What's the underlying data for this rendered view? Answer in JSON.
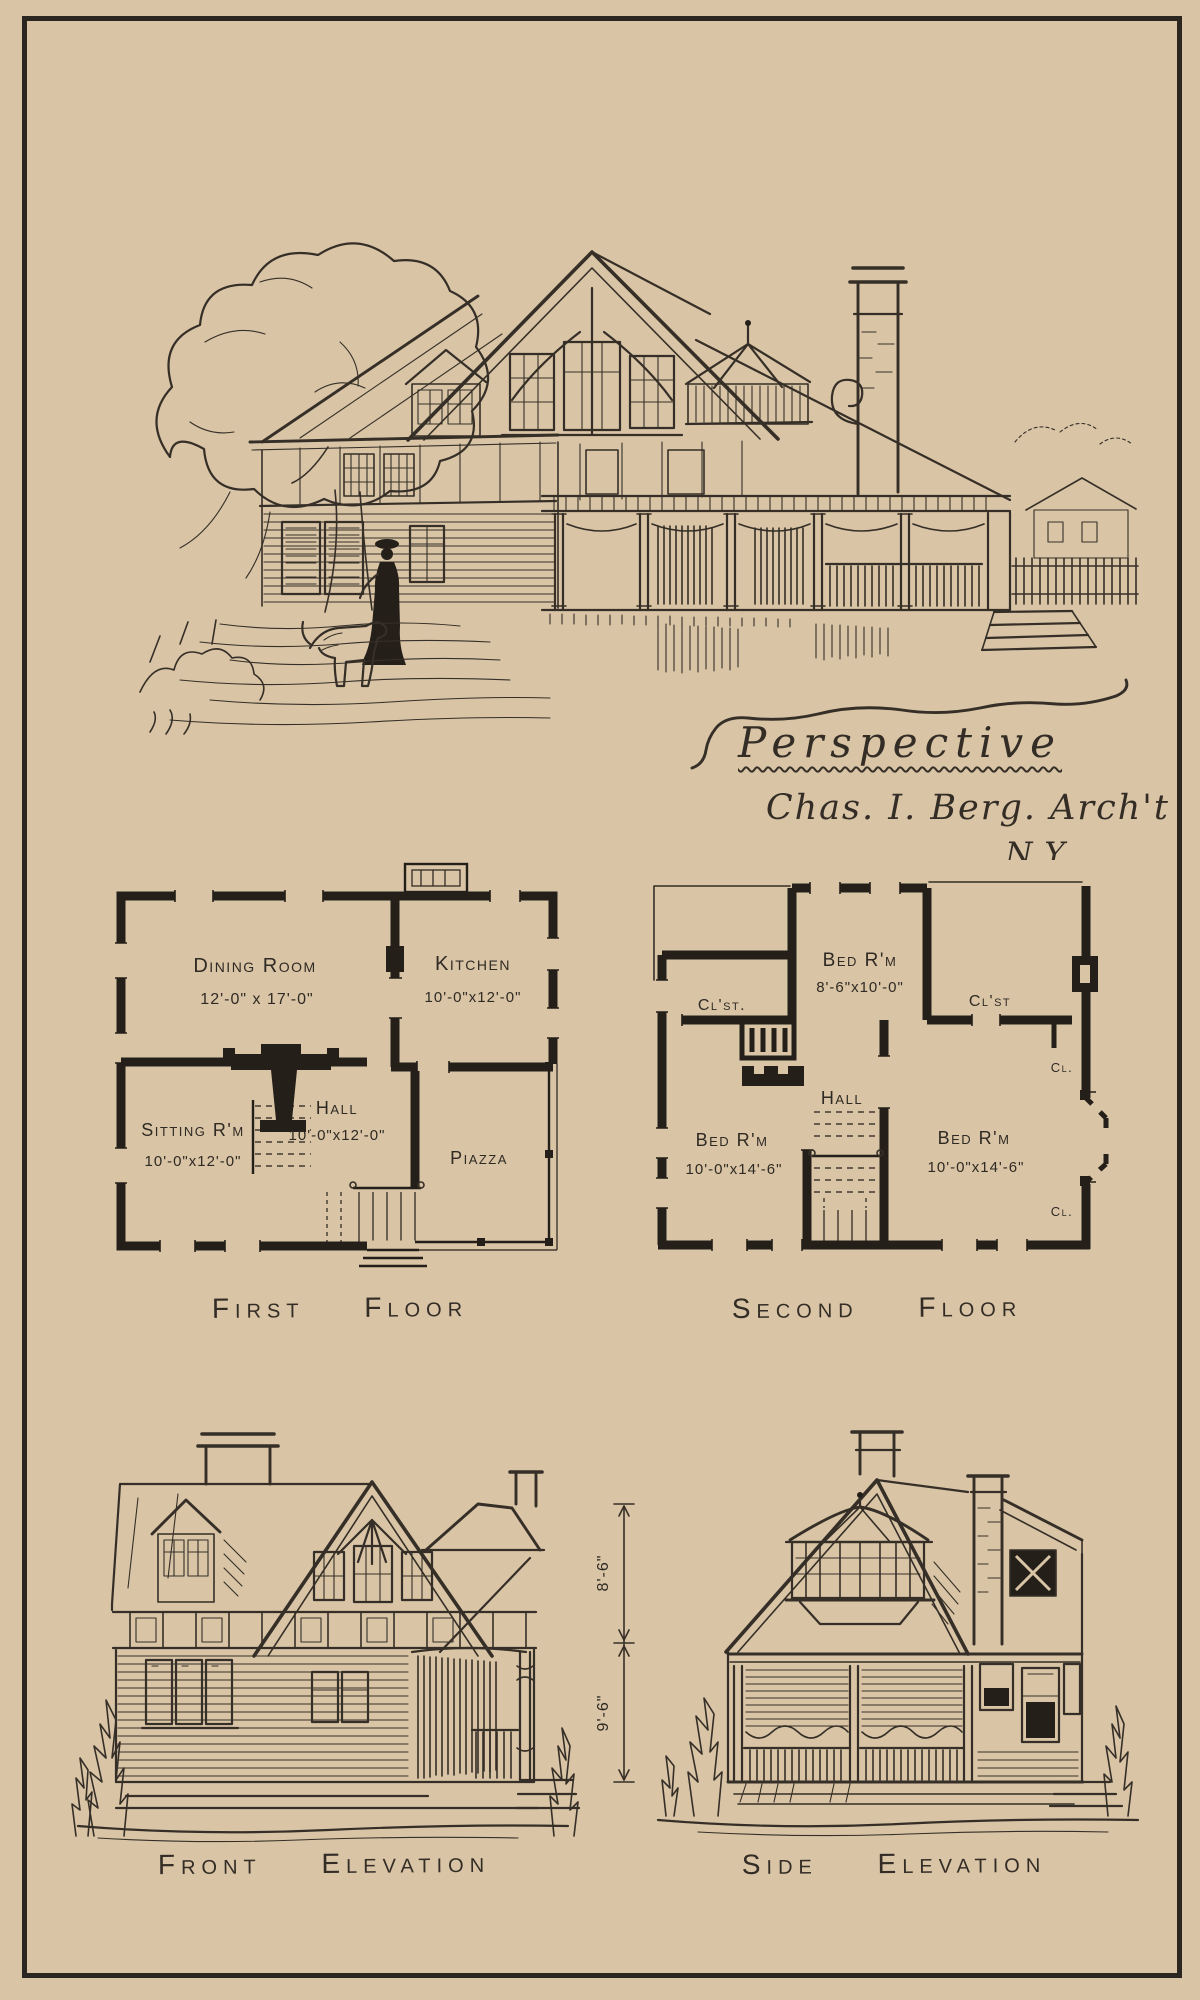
{
  "plate": {
    "perspective_label": "Perspective",
    "architect": "Chas. I. Berg. Arch't",
    "city": "N.Y."
  },
  "first_floor": {
    "caption": "First Floor",
    "dining": {
      "name": "Dining Room",
      "dims": "12'-0\" x 17'-0\""
    },
    "kitchen": {
      "name": "Kitchen",
      "dims": "10'-0\"x12'-0\""
    },
    "sitting": {
      "name": "Sitting R'm",
      "dims": "10'-0\"x12'-0\""
    },
    "hall": {
      "name": "Hall",
      "dims": "10'-0\"x12'-0\""
    },
    "piazza": {
      "name": "Piazza"
    }
  },
  "second_floor": {
    "caption": "Second Floor",
    "bed_top": {
      "name": "Bed R'm",
      "dims": "8'-6\"x10'-0\""
    },
    "closet_left": {
      "name": "Cl'st."
    },
    "closet_right": {
      "name": "Cl'st"
    },
    "closet_upper_right": {
      "name": "Cl."
    },
    "hall": {
      "name": "Hall"
    },
    "bed_left": {
      "name": "Bed R'm",
      "dims": "10'-0\"x14'-6\""
    },
    "bed_right": {
      "name": "Bed R'm",
      "dims": "10'-0\"x14'-6\""
    },
    "closet_lower_right": {
      "name": "Cl."
    }
  },
  "elevations": {
    "front_caption": "Front Elevation",
    "side_caption": "Side Elevation",
    "dim_upper": "8'-6\"",
    "dim_lower": "9'-6\""
  },
  "colors": {
    "paper": "#d9c4a6",
    "ink": "#352f27",
    "wall": "#241f19"
  }
}
